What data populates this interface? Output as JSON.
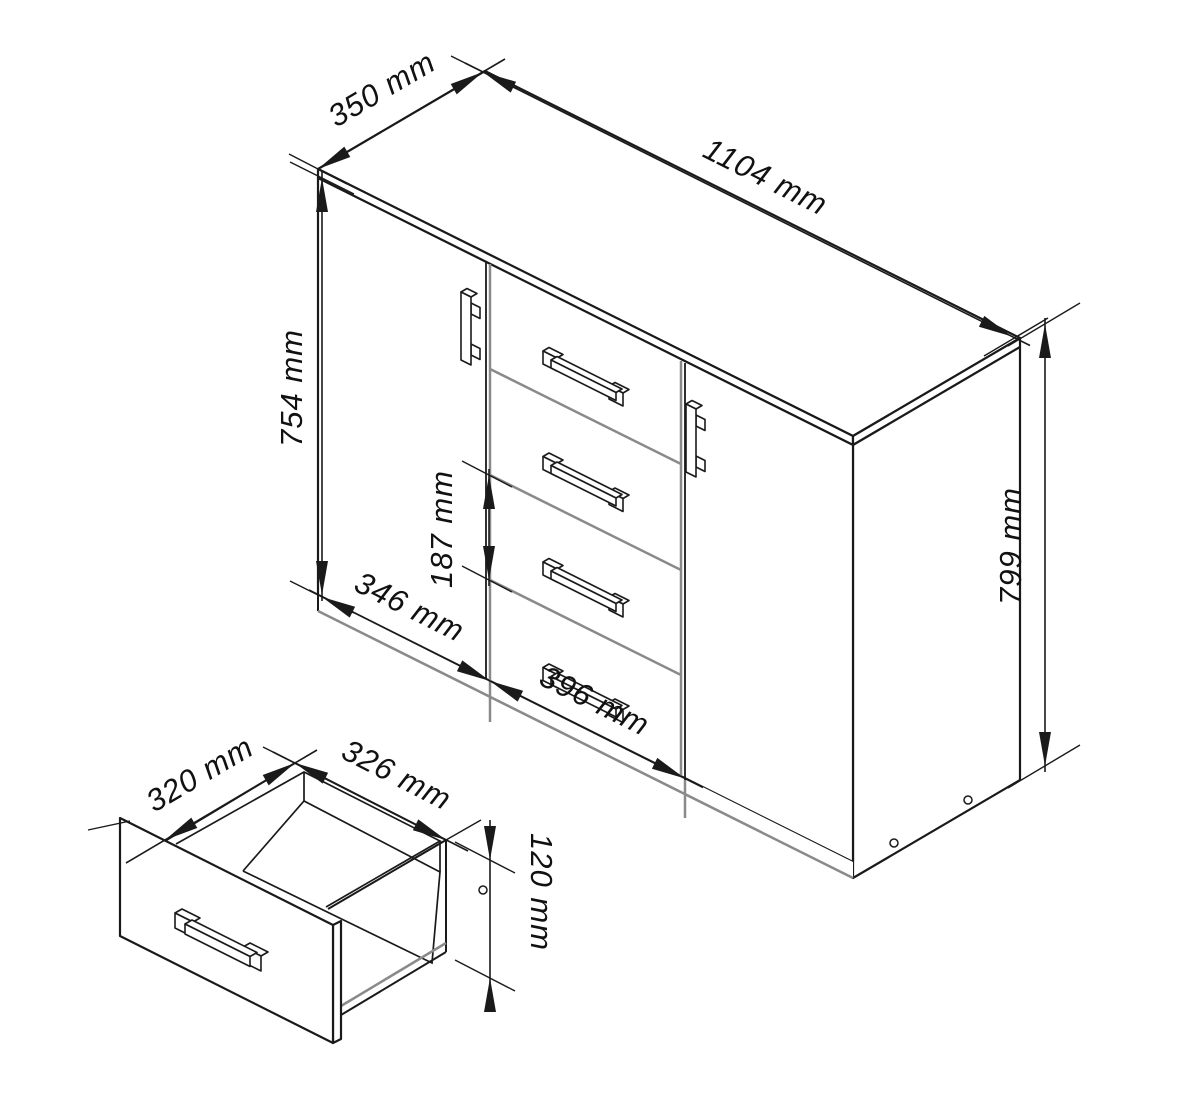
{
  "drawing": {
    "description": "Isometric technical drawing of a sideboard cabinet (two doors, four central drawers) with a separate open-drawer detail view",
    "background_color": "#ffffff",
    "line_color": "#1a1a1a",
    "secondary_line_color": "#8a8a8a",
    "cabinet_view": {
      "dims": {
        "depth": "350 mm",
        "width": "1104 mm",
        "door_height": "754 mm",
        "height": "799 mm",
        "drawer_pitch": "187 mm",
        "door_width": "346 mm",
        "drawer_width": "396 mm"
      }
    },
    "drawer_view": {
      "dims": {
        "depth": "320 mm",
        "width": "326 mm",
        "front_height": "120 mm"
      }
    }
  }
}
